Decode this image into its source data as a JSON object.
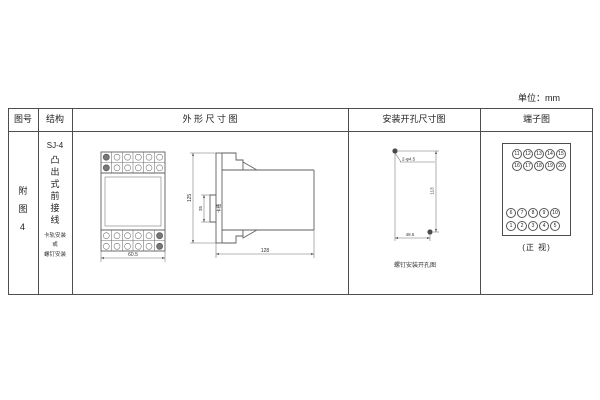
{
  "unit_label": "单位：mm",
  "table": {
    "headers": [
      "图号",
      "结构",
      "外 形 尺 寸 图",
      "安装开孔尺寸图",
      "端子图"
    ]
  },
  "figure_column": {
    "figure_no": "附图4"
  },
  "structure_column": {
    "model": "SJ-4",
    "mounting_type": "凸出式前接线",
    "note": [
      "卡轨安装",
      "或",
      "螺钉安装"
    ]
  },
  "outline_section": {
    "front_view": {
      "width_dim": "60.5"
    },
    "side_view": {
      "height_dim": "125",
      "slot_dim": "35",
      "slot_label": "卡槽",
      "depth_dim": "128"
    }
  },
  "mounting_section": {
    "holes_label": "2-φ4.5",
    "vertical_dim": "113",
    "horizontal_dim": "48.5",
    "caption": "螺钉安装开孔图"
  },
  "terminal_section": {
    "rows": [
      [
        "11",
        "12",
        "13",
        "14",
        "15"
      ],
      [
        "16",
        "17",
        "18",
        "19",
        "20"
      ],
      [
        "6",
        "7",
        "8",
        "9",
        "10"
      ],
      [
        "1",
        "2",
        "3",
        "4",
        "5"
      ]
    ],
    "caption": "(正 视)"
  },
  "colors": {
    "ink": "#4d4d4d",
    "paper": "#ffffff"
  }
}
